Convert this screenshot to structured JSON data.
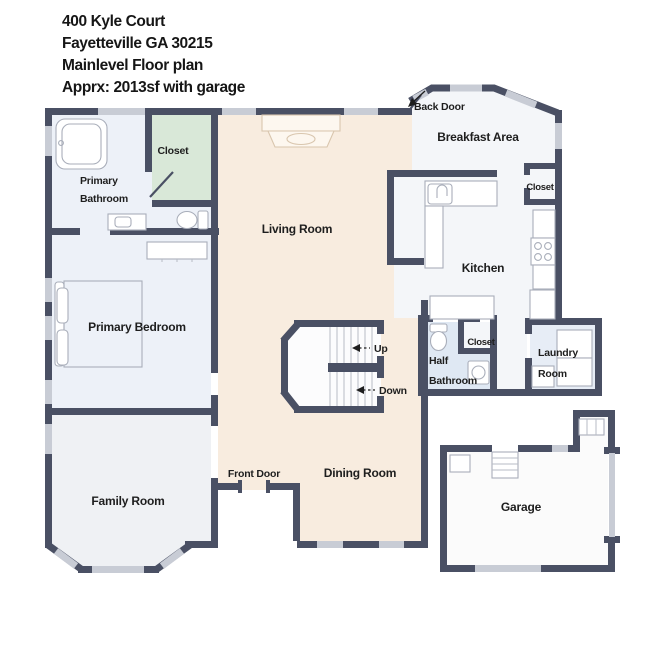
{
  "header": {
    "line1": "400 Kyle Court",
    "line2": "Fayetteville GA 30215",
    "line3": "Mainlevel Floor plan",
    "line4": "Apprx: 2013sf with garage"
  },
  "rooms": {
    "living_room": "Living Room",
    "dining_room": "Dining Room",
    "family_room": "Family Room",
    "primary_bedroom": "Primary Bedroom",
    "primary_bathroom": {
      "line1": "Primary",
      "line2": "Bathroom"
    },
    "half_bathroom": {
      "line1": "Half",
      "line2": "Bathroom"
    },
    "kitchen": "Kitchen",
    "breakfast_area": "Breakfast Area",
    "laundry_room": {
      "line1": "Laundry",
      "line2": "Room"
    },
    "garage": "Garage",
    "closet_bathroom": "Closet",
    "closet_kitchen": "Closet",
    "closet_hall": "Closet"
  },
  "annotations": {
    "back_door": "Back Door",
    "front_door": "Front Door",
    "stairs_up": "Up",
    "stairs_down": "Down"
  },
  "colors": {
    "wall": "#4a5064",
    "win": "#c8ccd5",
    "cream": "#f8ecdf",
    "blue": "#edf1f8",
    "blue2": "#dfe8f3",
    "blue3": "#e7edf6",
    "green": "#d9e8d8",
    "gray": "#eff1f4",
    "white": "#f4f6f9",
    "stairs": "#fcfcfd",
    "garage": "#fbfbfb",
    "text": "#1e1e1e"
  }
}
